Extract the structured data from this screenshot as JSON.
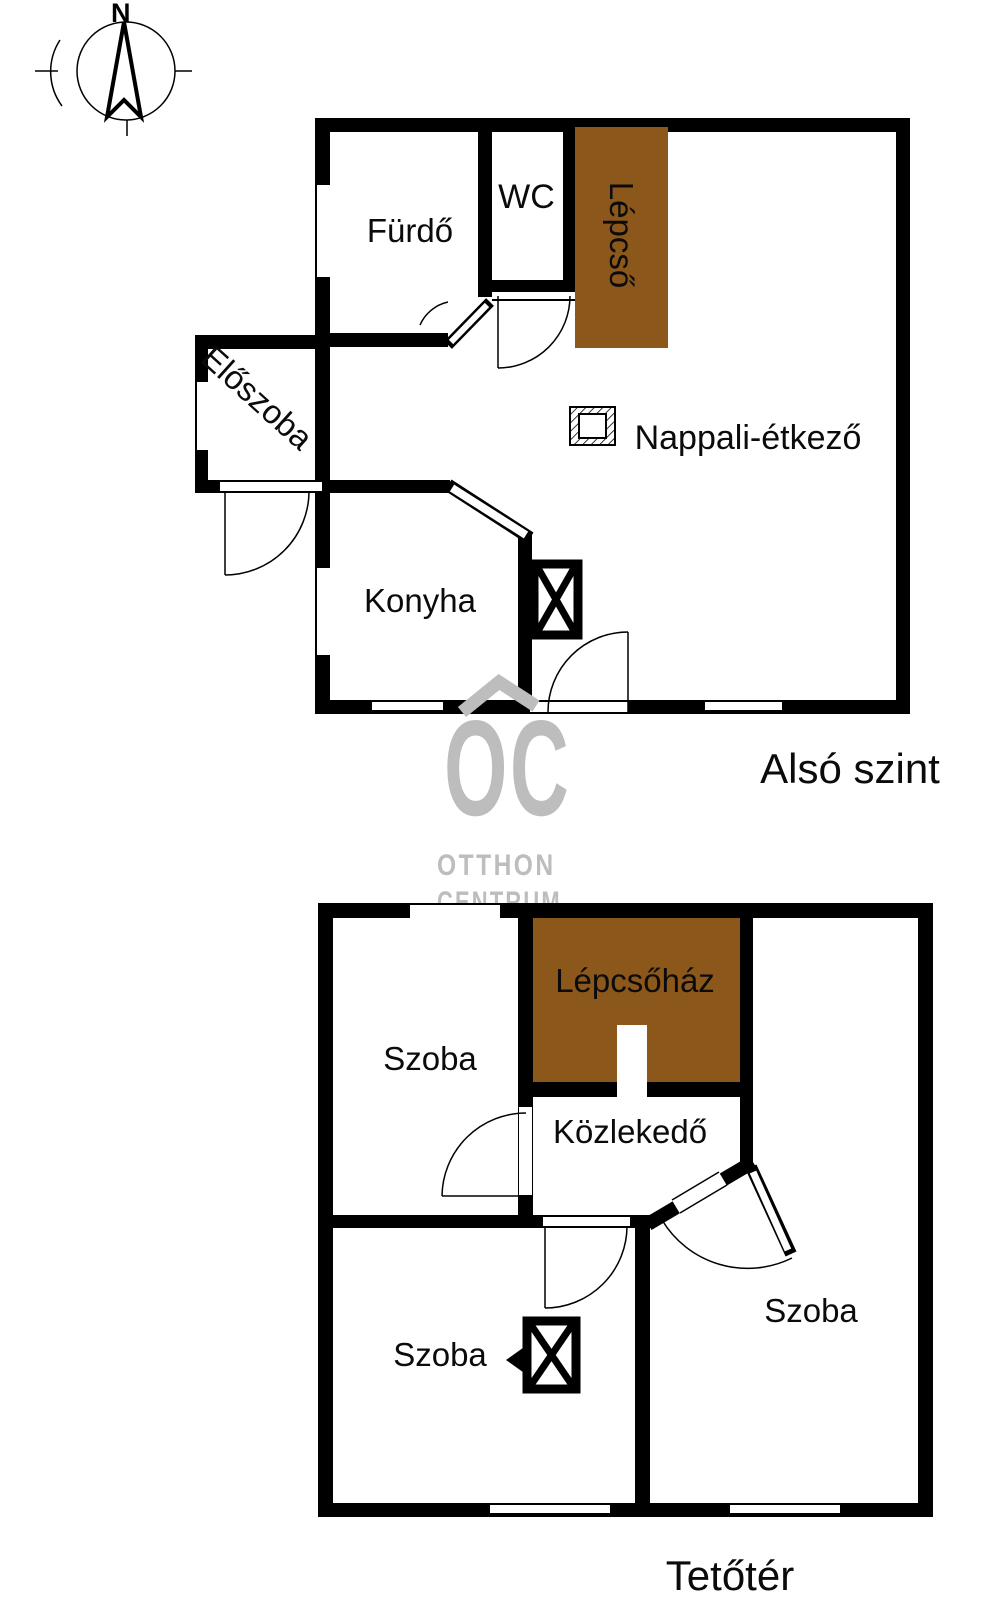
{
  "compass": {
    "north_label": "N"
  },
  "watermark": {
    "monogram": "OC",
    "word1": "OTTHON",
    "word2": "CENTRUM",
    "color": "#bdbdbd"
  },
  "colors": {
    "wall": "#000000",
    "stairs_fill": "#8c571a",
    "watermark_gray": "#bdbdbd"
  },
  "floor_lower": {
    "caption": "Alsó szint",
    "rooms": {
      "furdo": "Fürdő",
      "wc": "WC",
      "lepcso": "Lépcső",
      "eloszoba": "Előszoba",
      "nappali": "Nappali-étkező",
      "konyha": "Konyha"
    }
  },
  "floor_attic": {
    "caption": "Tetőtér",
    "rooms": {
      "szoba_nw": "Szoba",
      "lepcsohaz": "Lépcsőház",
      "kozlekedo": "Közlekedő",
      "szoba_sw": "Szoba",
      "szoba_e": "Szoba"
    }
  }
}
